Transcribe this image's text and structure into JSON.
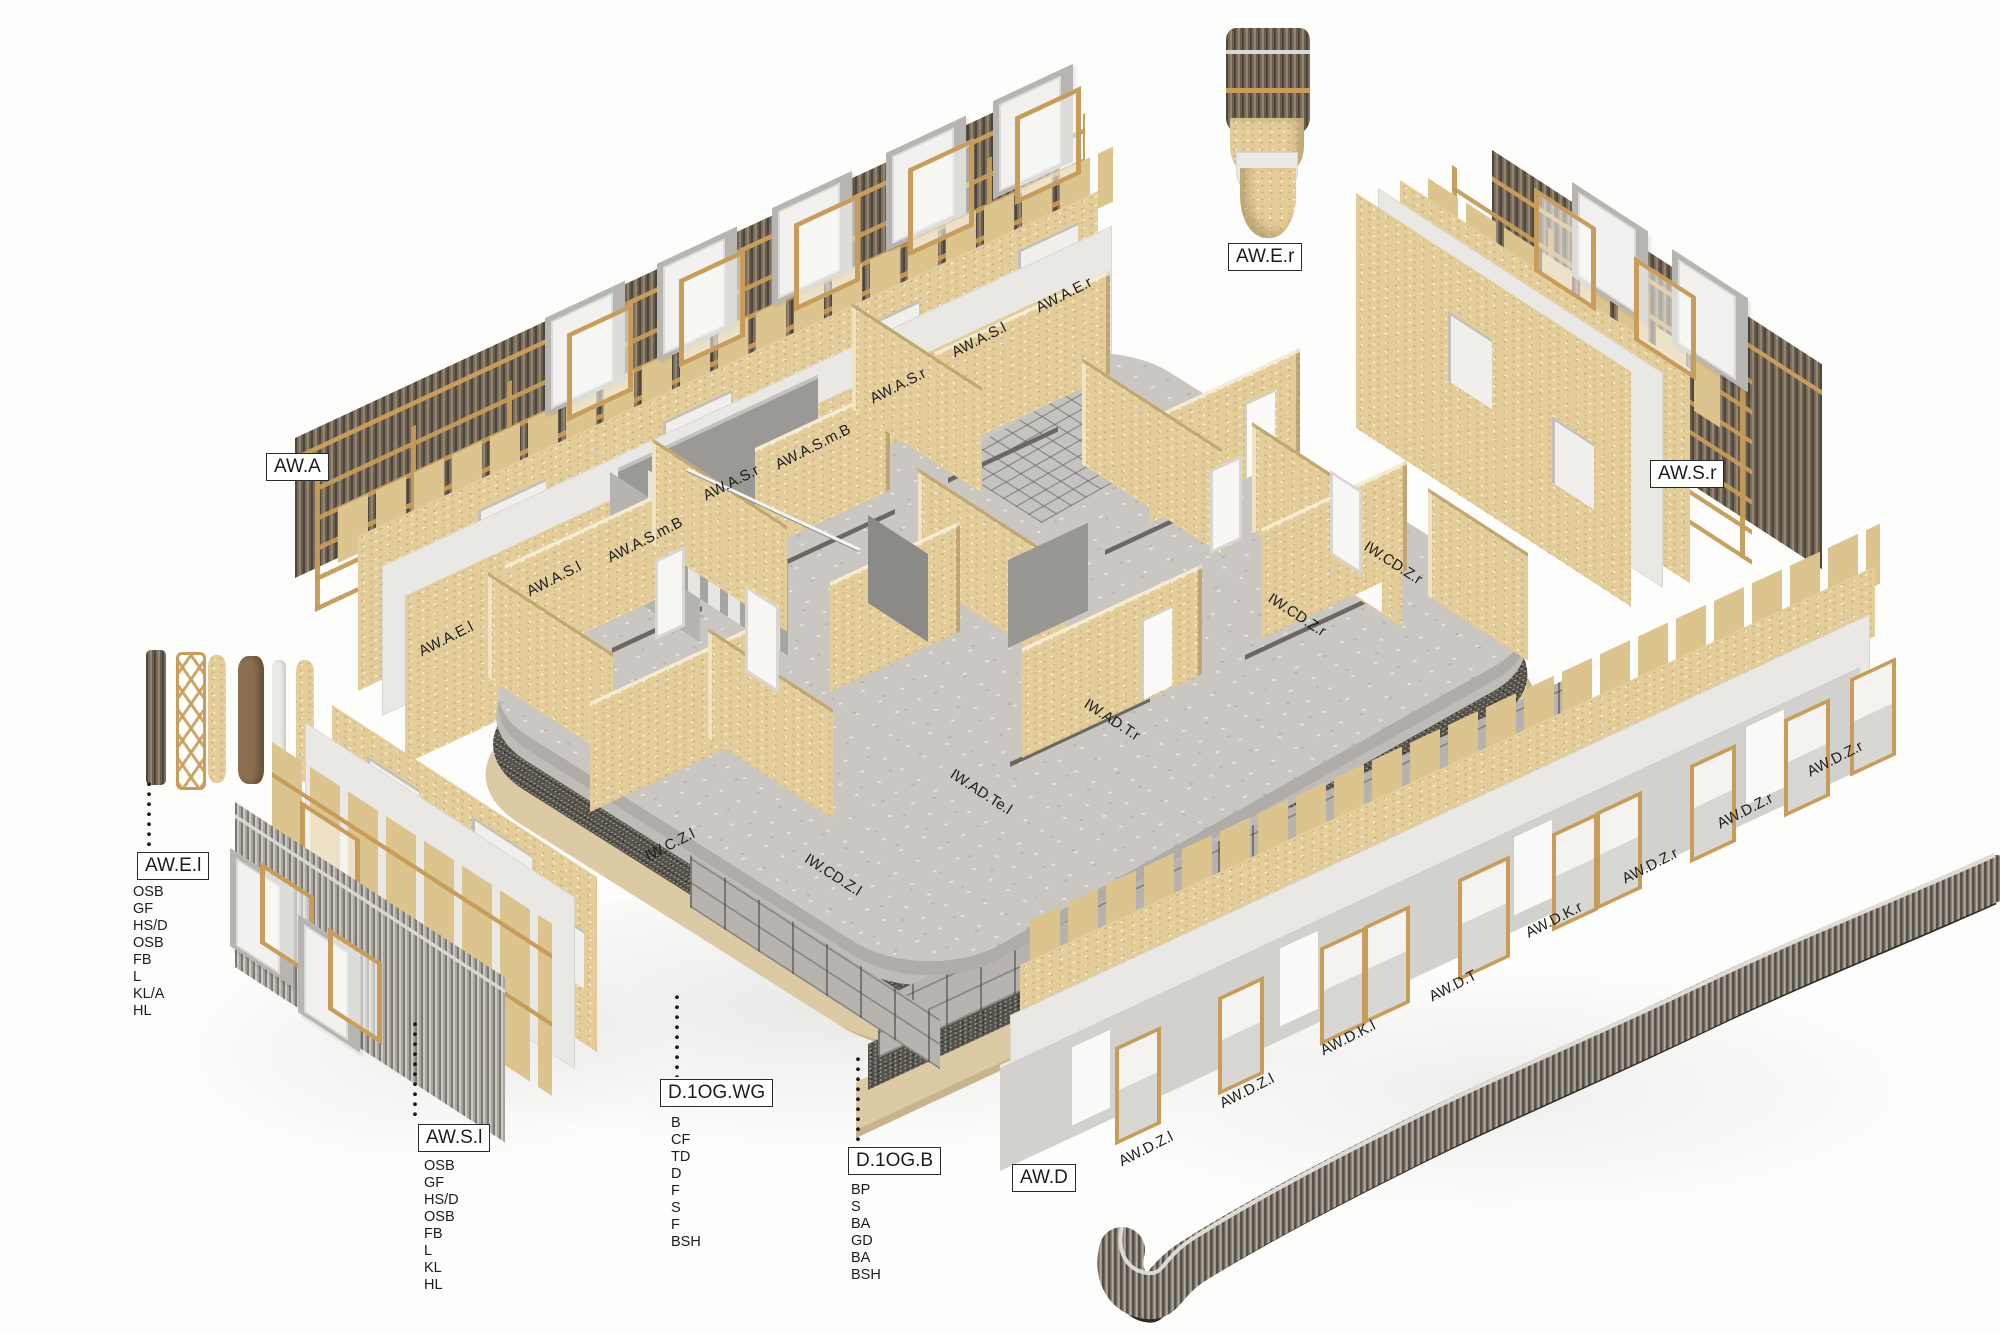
{
  "diagram": {
    "type": "exploded-axonometric-construction-diagram",
    "subject": "timber building storey with exploded wall and floor assemblies"
  },
  "colors": {
    "osb_panel": "#e3cd9b",
    "timber_frame": "#c89d5c",
    "dark_slat_cladding": "#6b5e50",
    "grey_panel": "#d3d1cd",
    "white_sheet": "#eae8e4",
    "concrete_slab": "#cac7c2",
    "dark_insulation": "#55514b",
    "timber_cream_slab": "#dccaa4",
    "tile_deck": "#b7b4af",
    "label_ink": "#1c1c1c"
  },
  "boxed_labels": {
    "aw_a": "AW.A",
    "aw_e_r": "AW.E.r",
    "aw_s_r": "AW.S.r",
    "aw_e_l": "AW.E.l",
    "aw_s_l": "AW.S.l",
    "d_1og_wg": "D.1OG.WG",
    "d_1og_b": "D.1OG.B",
    "aw_d": "AW.D"
  },
  "panel_labels": {
    "aw_a_row": [
      "AW.A.E.l",
      "AW.A.S.l",
      "AW.A.S.m.B",
      "AW.A.S.r",
      "AW.A.S.m.B",
      "AW.A.S.r",
      "AW.A.S.l",
      "AW.A.E.r"
    ],
    "aw_d_row": [
      "AW.D.Z.l",
      "AW.D.Z.l",
      "AW.D.K.l",
      "AW.D.T",
      "AW.D.K.r",
      "AW.D.Z.r",
      "AW.D.Z.r",
      "AW.D.Z.r"
    ],
    "interior": [
      "IW.C.Z.l",
      "IW.CD.Z.l",
      "IW.AD.Te.l",
      "IW.AD.T.r",
      "IW.CD.Z.r",
      "IW.CD.Z.r"
    ]
  },
  "material_lists": {
    "aw_e_l": [
      "OSB",
      "GF",
      "HS/D",
      "OSB",
      "FB",
      "L",
      "KL/A",
      "HL"
    ],
    "aw_s_l": [
      "OSB",
      "GF",
      "HS/D",
      "OSB",
      "FB",
      "L",
      "KL",
      "HL"
    ],
    "d_1og_wg": [
      "B",
      "CF",
      "TD",
      "D",
      "F",
      "S",
      "F",
      "BSH"
    ],
    "d_1og_b": [
      "BP",
      "S",
      "BA",
      "GD",
      "BA",
      "BSH"
    ]
  }
}
